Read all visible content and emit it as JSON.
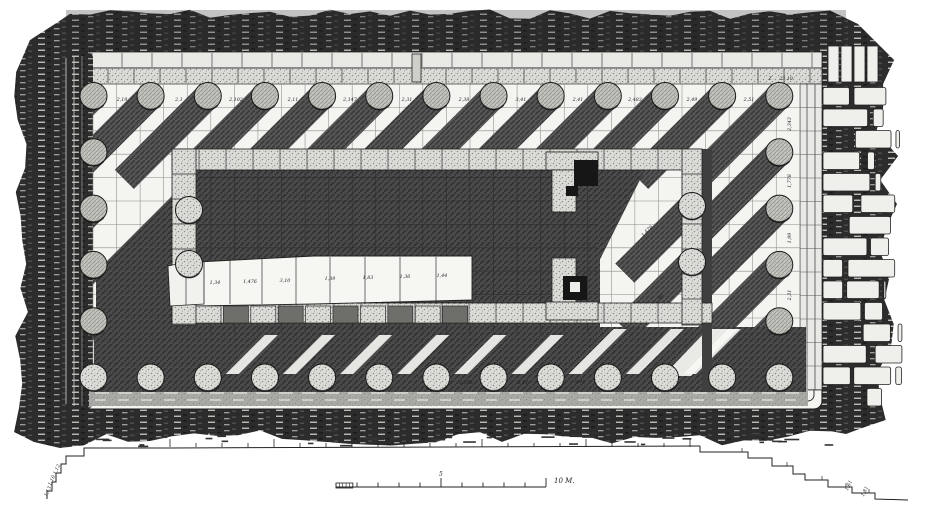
{
  "figure": {
    "kind": "architectural-plan",
    "subject": "Ruined peripteral temple — measured ground plan (engraving style)",
    "canvas": {
      "w": 944,
      "h": 512
    },
    "palette": {
      "paper": "#ffffff",
      "ink": "#1a1a1a",
      "ground_dark": "#2c2c2c",
      "shadow": "#565656",
      "cella_dark": "#4a4a4a",
      "block_light": "#e9e9e6",
      "stipple": "#dcdcd8",
      "column_fill": "#c4c4c0",
      "grid_line": "#8a8a86"
    }
  },
  "plan": {
    "platform": {
      "x": 74,
      "y": 52,
      "w": 748,
      "h": 357,
      "step_insets": [
        0,
        8,
        15
      ],
      "stylobate": {
        "x": 93,
        "y": 84,
        "w": 707,
        "h": 306
      }
    },
    "grid": {
      "origin_x": 93,
      "origin_y": 84,
      "dx": 23.56,
      "dy": 23.4
    },
    "peristyle": {
      "flank_columns": 13,
      "front_columns": 6,
      "first_x": 93.5,
      "first_y": 96,
      "dx": 57.15,
      "dy": 56.3,
      "radius": 13.5
    },
    "porch_columns": [
      [
        189,
        210
      ],
      [
        189,
        264
      ],
      [
        692,
        206
      ],
      [
        692,
        262
      ]
    ],
    "shadow": {
      "direction": "down-left",
      "angle_deg": 45,
      "length": 118,
      "width": 27
    },
    "cella": {
      "north_wall": {
        "x": 172,
        "y": 149,
        "w": 530,
        "h": 21
      },
      "south_wall": {
        "x": 172,
        "y": 303,
        "w": 540,
        "h": 20
      },
      "west_wall": {
        "x": 172,
        "y": 149,
        "w": 24,
        "h": 176
      },
      "east_front": {
        "x": 682,
        "y": 149,
        "w": 20,
        "h": 176
      },
      "interior_dark": {
        "x": 196,
        "y": 168,
        "w": 404,
        "h": 167
      },
      "foundation_strip": {
        "x": 196,
        "y": 254,
        "w": 276,
        "h": 50
      },
      "door_features": "T-and-L shaped anta blocks with black sockets"
    },
    "south_band": {
      "x": 94,
      "y": 327,
      "w": 712,
      "h": 65
    },
    "masonry_debris": {
      "x": 822,
      "y": 44,
      "w": 86,
      "h": 356,
      "rows": 15
    },
    "scale_bar": {
      "x": 336,
      "y": 487,
      "length": 210,
      "label": "10 M.",
      "mid_label": "5",
      "divisions": 10
    },
    "terrace_line": {
      "y": 447,
      "x0": 170,
      "x1": 700
    }
  },
  "annotations": [
    {
      "x": 122,
      "y": 101,
      "t": "2,19"
    },
    {
      "x": 179,
      "y": 101,
      "t": "2,1"
    },
    {
      "x": 236,
      "y": 101,
      "t": "2,102"
    },
    {
      "x": 293,
      "y": 101,
      "t": "2,11"
    },
    {
      "x": 350,
      "y": 101,
      "t": "2,147"
    },
    {
      "x": 407,
      "y": 101,
      "t": "2,31"
    },
    {
      "x": 464,
      "y": 101,
      "t": "2,38"
    },
    {
      "x": 521,
      "y": 101,
      "t": "3,41"
    },
    {
      "x": 578,
      "y": 101,
      "t": "2,41"
    },
    {
      "x": 635,
      "y": 101,
      "t": "2,483"
    },
    {
      "x": 692,
      "y": 101,
      "t": "2,49"
    },
    {
      "x": 749,
      "y": 101,
      "t": "2,51"
    },
    {
      "x": 770,
      "y": 80,
      "t": "Z"
    },
    {
      "x": 786,
      "y": 80,
      "t": "23,10"
    },
    {
      "x": 791,
      "y": 124,
      "t": "2,343",
      "r": -90
    },
    {
      "x": 791,
      "y": 181,
      "t": "1,778",
      "r": -90
    },
    {
      "x": 791,
      "y": 238,
      "t": "1,99",
      "r": -90
    },
    {
      "x": 791,
      "y": 295,
      "t": "2,31",
      "r": -90
    },
    {
      "x": 215,
      "y": 284,
      "t": "1,34"
    },
    {
      "x": 250,
      "y": 283,
      "t": "1,476"
    },
    {
      "x": 285,
      "y": 282,
      "t": "3,10"
    },
    {
      "x": 330,
      "y": 280,
      "t": "1,39"
    },
    {
      "x": 368,
      "y": 279,
      "t": "1,83"
    },
    {
      "x": 405,
      "y": 278,
      "t": "1,36"
    },
    {
      "x": 442,
      "y": 277,
      "t": "1,44"
    },
    {
      "x": 466,
      "y": 384,
      "t": "2,195"
    },
    {
      "x": 523,
      "y": 384,
      "t": "2,11"
    },
    {
      "x": 580,
      "y": 383,
      "t": "2,41"
    },
    {
      "x": 648,
      "y": 232,
      "t": "1,476",
      "r": -45
    },
    {
      "x": 660,
      "y": 300,
      "t": "1,99",
      "r": -45
    },
    {
      "x": 58,
      "y": 470,
      "t": "1,12",
      "r": -65
    },
    {
      "x": 53,
      "y": 481,
      "t": "1,10",
      "r": -65
    },
    {
      "x": 49,
      "y": 492,
      "t": "1,13",
      "r": -65
    },
    {
      "x": 850,
      "y": 486,
      "t": "1,61",
      "r": -65
    },
    {
      "x": 866,
      "y": 492,
      "t": "1,81",
      "r": -65
    }
  ]
}
